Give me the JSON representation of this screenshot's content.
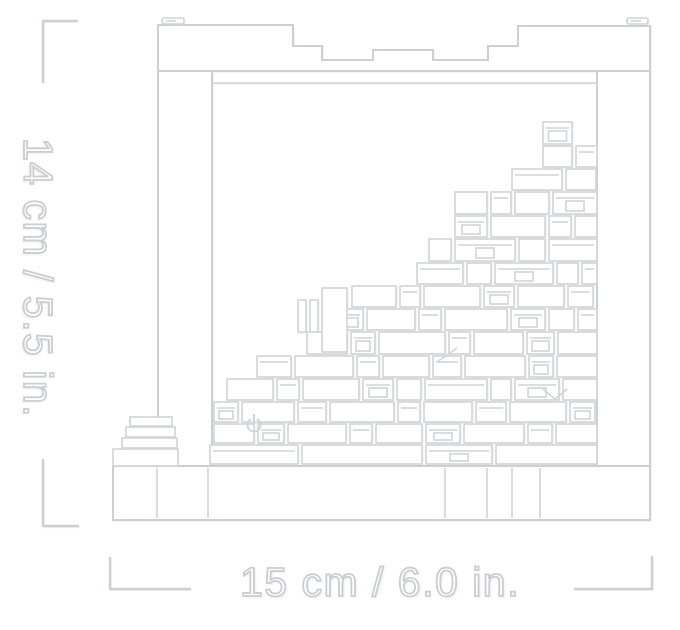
{
  "dimensions": {
    "height_label": "14 cm / 5.5 in.",
    "width_label": "15 cm / 6.0 in."
  },
  "colors": {
    "background": "#ffffff",
    "line": "#d2d4d6",
    "line_strong": "#cdd0d2",
    "bracket": "#cdd0d2",
    "text_outline": "#cbcdd0"
  },
  "icons": {
    "power_symbol": "power-icon"
  },
  "art": {
    "frame": {
      "top_wall_path": "M158,71 V25 H293 V46 H322 V60 H373 V50 H433 V60 H488 V46 H518 V26 H650 V71 Z",
      "inner_top_line": [
        213,
        83,
        597,
        83
      ],
      "left_wall": [
        158,
        71,
        54,
        395
      ],
      "right_wall": [
        597,
        71,
        53,
        449
      ],
      "base": [
        113,
        466,
        537,
        54
      ],
      "base_joints": [
        157,
        208,
        445,
        487,
        512,
        540
      ],
      "base_joint_y": [
        468,
        518
      ],
      "top_tabs": [
        [
          162,
          18,
          22,
          6
        ],
        [
          627,
          18,
          21,
          6
        ]
      ],
      "top_tab_dashes": [
        [
          166,
          21,
          176,
          21
        ],
        [
          631,
          21,
          641,
          21
        ]
      ]
    },
    "blocks": {
      "gap": 4,
      "right_default": 597,
      "rows": [
        {
          "y": 122,
          "h": 22,
          "x0": 543,
          "max": 572,
          "w": [
            29
          ]
        },
        {
          "y": 146,
          "h": 21,
          "x0": 543,
          "w": [
            29,
            22
          ]
        },
        {
          "y": 169,
          "h": 21,
          "x0": 512,
          "w": [
            50,
            30
          ]
        },
        {
          "y": 192,
          "h": 22,
          "x0": 455,
          "w": [
            32,
            20,
            34,
            44
          ]
        },
        {
          "y": 216,
          "h": 21,
          "x0": 455,
          "w": [
            32,
            54,
            22,
            28
          ]
        },
        {
          "y": 239,
          "h": 22,
          "x0": 429,
          "w": [
            22,
            60,
            26,
            48
          ]
        },
        {
          "y": 263,
          "h": 21,
          "x0": 417,
          "w": [
            46,
            24,
            58,
            21,
            19
          ]
        },
        {
          "y": 286,
          "h": 21,
          "x0": 352,
          "w": [
            44,
            20,
            56,
            30,
            46,
            25
          ]
        },
        {
          "y": 309,
          "h": 21,
          "x0": 337,
          "w": [
            26,
            48,
            22,
            62,
            34,
            25,
            29
          ]
        },
        {
          "y": 332,
          "h": 22,
          "x0": 307,
          "w": [
            40,
            24,
            66,
            21,
            49,
            27,
            40
          ]
        },
        {
          "y": 356,
          "h": 21,
          "x0": 257,
          "w": [
            34,
            58,
            22,
            46,
            28,
            60,
            24,
            40
          ]
        },
        {
          "y": 379,
          "h": 21,
          "x0": 227,
          "w": [
            46,
            22,
            56,
            30,
            24,
            62,
            20,
            44,
            34
          ]
        },
        {
          "y": 402,
          "h": 20,
          "x0": 214,
          "w": [
            24,
            52,
            28,
            64,
            22,
            48,
            30,
            56,
            25,
            20
          ]
        },
        {
          "y": 424,
          "h": 19,
          "x0": 214,
          "w": [
            40,
            26,
            58,
            22,
            46,
            34,
            60,
            24,
            48,
            20
          ]
        },
        {
          "y": 445,
          "h": 19,
          "x0": 210,
          "w": [
            88,
            120,
            66,
            140,
            52
          ]
        }
      ]
    },
    "extras": {
      "rects": [
        [
          130,
          417,
          42,
          9
        ],
        [
          126,
          427,
          49,
          10
        ],
        [
          122,
          438,
          55,
          10
        ],
        [
          113,
          449,
          65,
          17
        ],
        [
          322,
          288,
          25,
          64
        ],
        [
          298,
          300,
          8,
          32
        ],
        [
          310,
          300,
          8,
          32
        ]
      ],
      "lines": [
        [
          437,
          362,
          457,
          348
        ]
      ],
      "polylines": [
        "543,389 555,399 567,389"
      ],
      "power": {
        "cx": 254,
        "cy": 425,
        "r": 6.5,
        "stem_y1": 414,
        "stem_y2": 424
      }
    },
    "brackets": [
      "M77,21 H43 V82",
      "M43,460 V526 H78",
      "M110,558 V589 H190",
      "M575,589 H652 V557"
    ]
  }
}
